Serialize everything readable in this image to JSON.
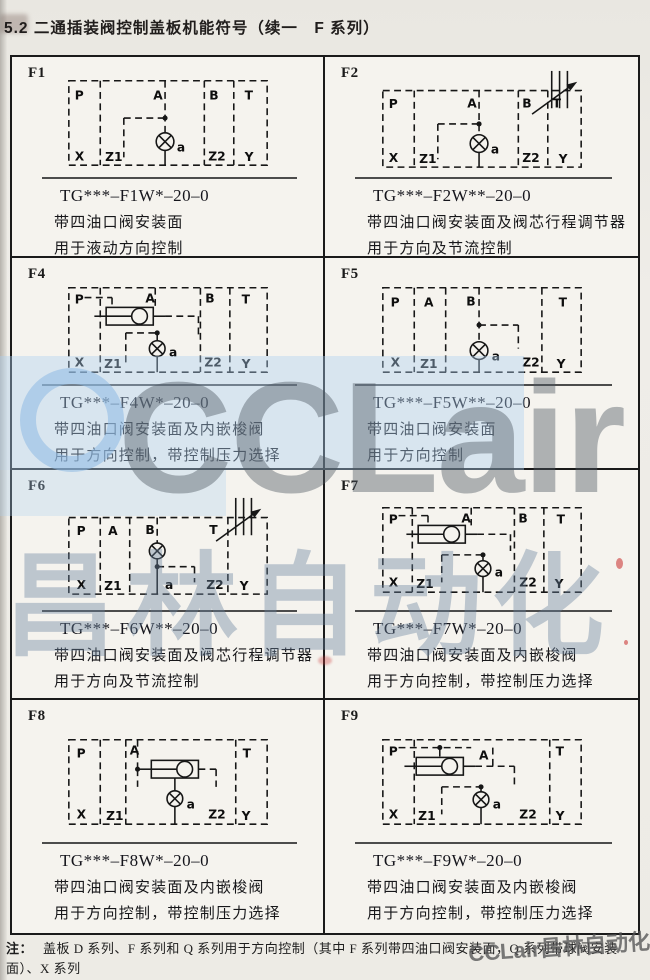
{
  "page": {
    "title": "5.2 二通插装阀控制盖板机能符号（续一　F 系列）",
    "note": {
      "prefix": "注：",
      "line1": "盖板 D 系列、F 系列和 Q 系列用于方向控制（其中 F 系列带四油口阀安装面，Q 系列带球阀安装面）、X 系列",
      "line2": "用于压力控制；J 系列用于组成减压控制单元。"
    }
  },
  "watermark": {
    "logo_text": "CCLair",
    "cn_text": "昌林自动化",
    "corner_text": "CCLair昌林自动化",
    "accent_blue": "#aecfee",
    "accent_gray": "#5f666d"
  },
  "cells": [
    {
      "id": "F1",
      "model": "TG***–F1W*–20–0",
      "desc1": "带四油口阀安装面",
      "desc2": "用于液动方向控制",
      "ports": {
        "p": "P",
        "a": "A",
        "b": "B",
        "t": "T",
        "x": "X",
        "z1": "Z1",
        "z2": "Z2",
        "y": "Y",
        "pilot": "a"
      }
    },
    {
      "id": "F2",
      "model": "TG***–F2W**–20–0",
      "desc1": "带四油口阀安装面及阀芯行程调节器",
      "desc2": "用于方向及节流控制",
      "ports": {
        "p": "P",
        "a": "A",
        "b": "B",
        "t": "T",
        "x": "X",
        "z1": "Z1",
        "z2": "Z2",
        "y": "Y",
        "pilot": "a"
      }
    },
    {
      "id": "F4",
      "model": "TG***–F4W*–20–0",
      "desc1": "带四油口阀安装面及内嵌梭阀",
      "desc2": "用于方向控制，带控制压力选择",
      "ports": {
        "p": "P",
        "a": "A",
        "b": "B",
        "t": "T",
        "x": "X",
        "z1": "Z1",
        "z2": "Z2",
        "y": "Y",
        "pilot": "a"
      }
    },
    {
      "id": "F5",
      "model": "TG***–F5W**–20–0",
      "desc1": "带四油口阀安装面",
      "desc2": "用于方向控制",
      "ports": {
        "p": "P",
        "a": "A",
        "b": "B",
        "t": "T",
        "x": "X",
        "z1": "Z1",
        "z2": "Z2",
        "y": "Y",
        "pilot": "a"
      }
    },
    {
      "id": "F6",
      "model": "TG***–F6W**–20–0",
      "desc1": "带四油口阀安装面及阀芯行程调节器",
      "desc2": "用于方向及节流控制",
      "ports": {
        "p": "P",
        "a": "A",
        "b": "B",
        "t": "T",
        "x": "X",
        "z1": "Z1",
        "z2": "Z2",
        "y": "Y",
        "pilot": "a"
      }
    },
    {
      "id": "F7",
      "model": "TG***–F7W*–20–0",
      "desc1": "带四油口阀安装面及内嵌梭阀",
      "desc2": "用于方向控制，带控制压力选择",
      "ports": {
        "p": "P",
        "a": "A",
        "b": "B",
        "t": "T",
        "x": "X",
        "z1": "Z1",
        "z2": "Z2",
        "y": "Y",
        "pilot": "a"
      }
    },
    {
      "id": "F8",
      "model": "TG***–F8W*–20–0",
      "desc1": "带四油口阀安装面及内嵌梭阀",
      "desc2": "用于方向控制，带控制压力选择",
      "ports": {
        "p": "P",
        "a": "A",
        "t": "T",
        "x": "X",
        "z1": "Z1",
        "z2": "Z2",
        "y": "Y",
        "pilot": "a"
      }
    },
    {
      "id": "F9",
      "model": "TG***–F9W*–20–0",
      "desc1": "带四油口阀安装面及内嵌梭阀",
      "desc2": "用于方向控制，带控制压力选择",
      "ports": {
        "p": "P",
        "a": "A",
        "t": "T",
        "x": "X",
        "z1": "Z1",
        "z2": "Z2",
        "y": "Y",
        "pilot": "a"
      }
    }
  ]
}
